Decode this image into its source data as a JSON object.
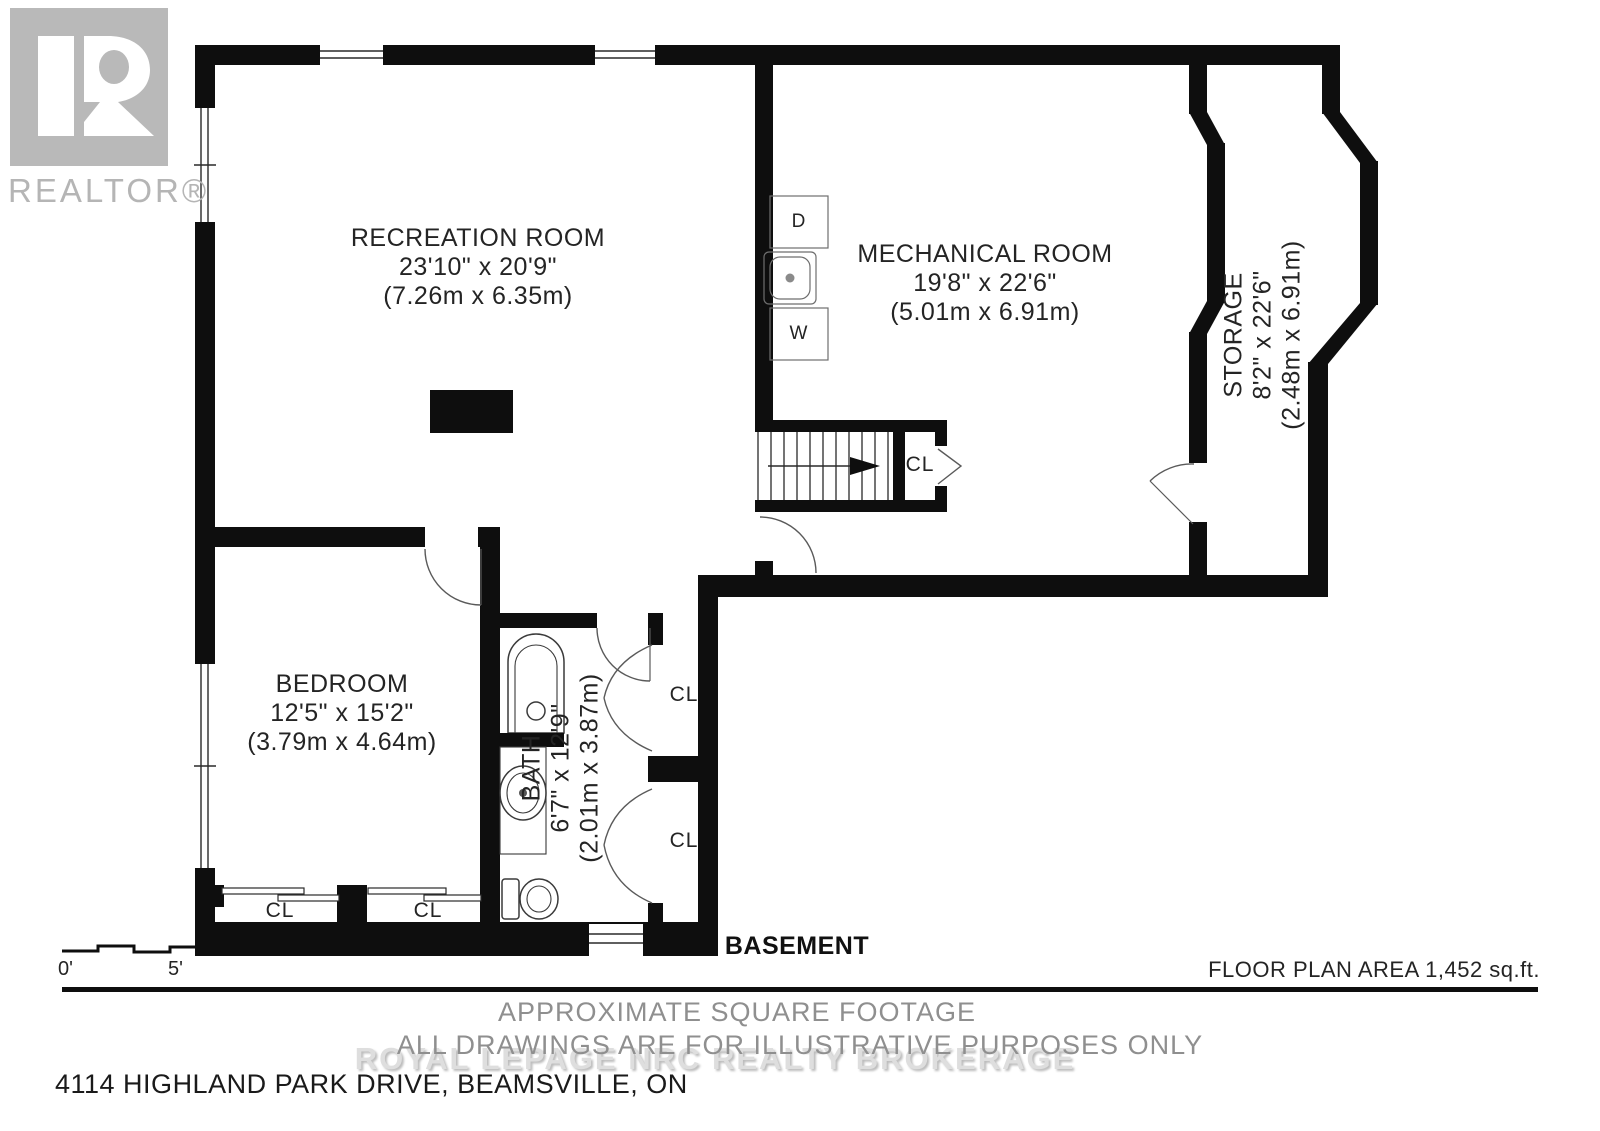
{
  "logo": {
    "brand": "REALTOR®"
  },
  "rooms": {
    "recreation": {
      "name": "RECREATION ROOM",
      "imperial": "23'10\" x 20'9\"",
      "metric": "(7.26m x 6.35m)"
    },
    "mechanical": {
      "name": "MECHANICAL ROOM",
      "imperial": "19'8\" x 22'6\"",
      "metric": "(5.01m x 6.91m)"
    },
    "storage": {
      "name": "STORAGE",
      "imperial": "8'2\" x 22'6\"",
      "metric": "(2.48m x 6.91m)"
    },
    "bedroom": {
      "name": "BEDROOM",
      "imperial": "12'5\" x 15'2\"",
      "metric": "(3.79m x 4.64m)"
    },
    "bath": {
      "name": "BATH",
      "imperial": "6'7\" x 12'9\"",
      "metric": "(2.01m x 3.87m)"
    }
  },
  "markers": {
    "closet": "CL",
    "dryer": "D",
    "washer": "W"
  },
  "scale_bar": {
    "start": "0'",
    "end": "5'"
  },
  "footer": {
    "floor_name": "BASEMENT",
    "area": "FLOOR PLAN AREA 1,452 sq.ft.",
    "approx": "APPROXIMATE SQUARE FOOTAGE",
    "disclaimer": "ALL DRAWINGS ARE FOR ILLUSTRATIVE PURPOSES ONLY",
    "watermark": "ROYAL LEPAGE NRC REALTY BROKERAGE",
    "address": "4114 HIGHLAND PARK DRIVE, BEAMSVILLE, ON"
  },
  "colors": {
    "wall": "#0e0e0e",
    "logo_gray": "#b9b9b9",
    "muted_text": "#8f8f8f",
    "watermark": "#dedede"
  }
}
